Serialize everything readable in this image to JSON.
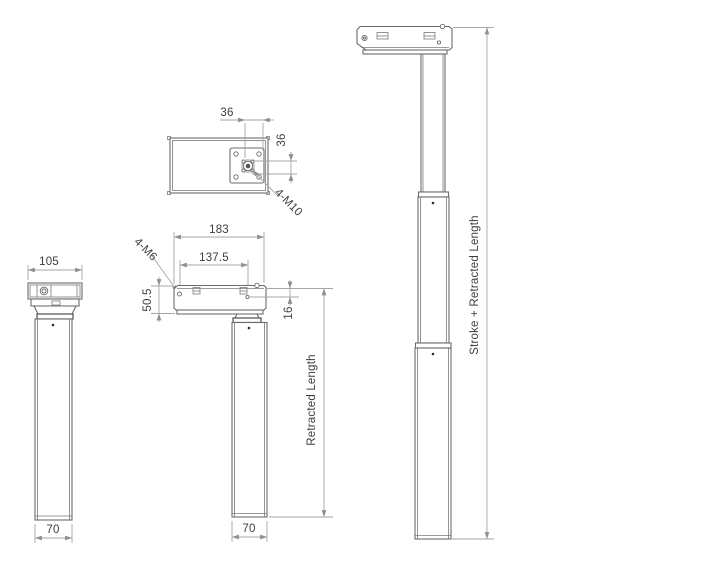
{
  "drawing": {
    "colors": {
      "background": "#ffffff",
      "object_line": "#6b6b6b",
      "dimension_line": "#a6a6a6",
      "dimension_text": "#3d3d3d"
    },
    "top_view": {
      "dim_hole_spacing_h": "36",
      "dim_hole_spacing_v": "36",
      "label_thread": "4-M10"
    },
    "side_view": {
      "dim_length": "183",
      "dim_hole_span": "137.5",
      "dim_height": "50.5",
      "dim_offset": "16",
      "label_thread": "4-M6",
      "dim_column_width": "70",
      "dim_retracted": "Retracted Length"
    },
    "front_view": {
      "dim_width": "105",
      "dim_column_width": "70"
    },
    "extended_view": {
      "dim_total": "Stroke + Retracted Length"
    }
  }
}
